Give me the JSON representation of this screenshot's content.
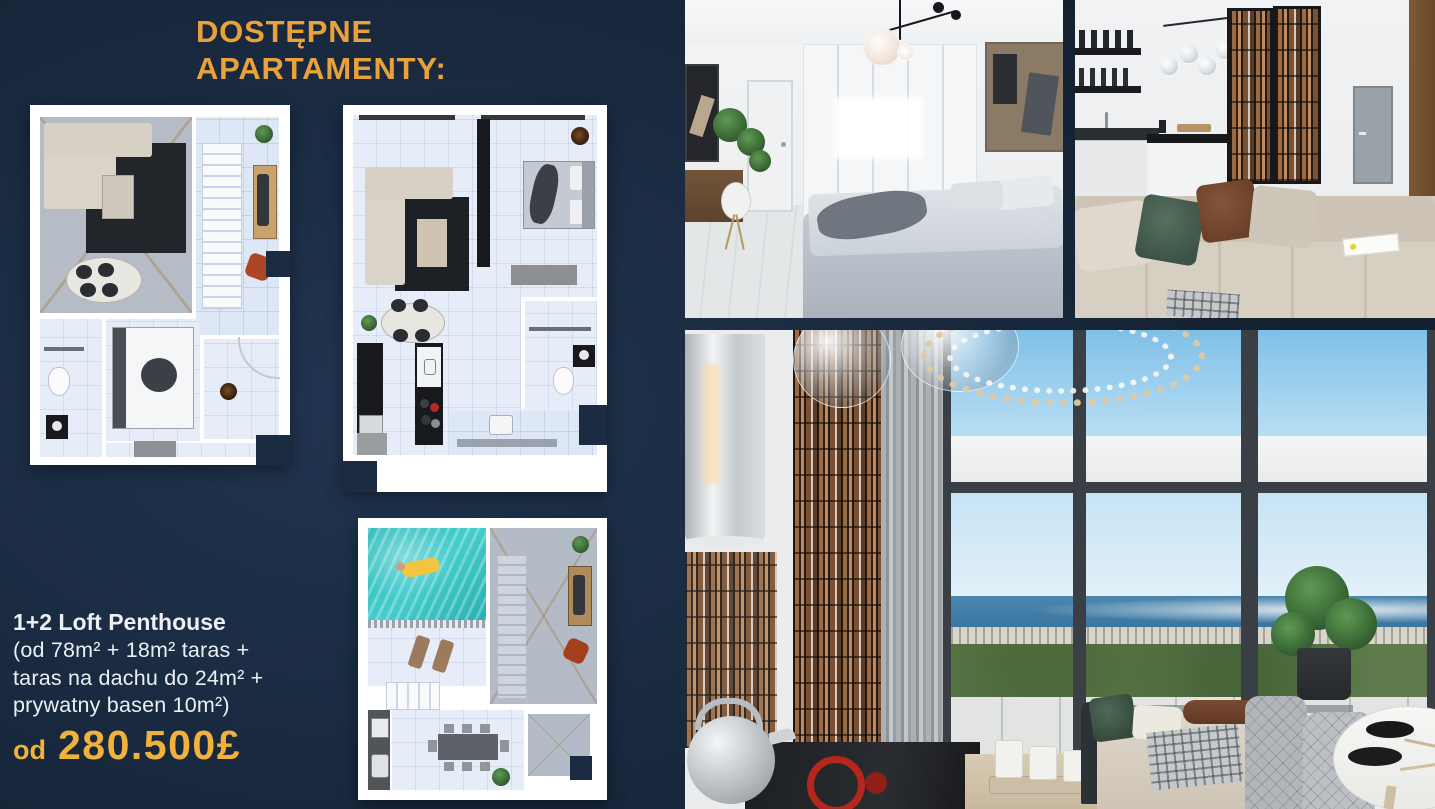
{
  "slide": {
    "title": {
      "line1": "DOSTĘPNE",
      "line2": "APARTAMENTY:"
    },
    "offer": {
      "name": "1+2 Loft Penthouse",
      "details": [
        "(od 78m² + 18m² taras +",
        "taras na dachu do 24m² +",
        "prywatny basen 10m²)"
      ],
      "price_prefix": "od",
      "price_value": "280.500£"
    },
    "colors": {
      "background_navy": "#1A2B42",
      "title_orange": "#E9A13C",
      "price_yellow": "#F1B23C",
      "text_white": "#ECEFF3"
    },
    "floorplans": [
      {
        "name": "apartment-main-level-floorplan"
      },
      {
        "name": "apartment-second-floorplan"
      },
      {
        "name": "roof-terrace-pool-floorplan"
      }
    ],
    "photos": [
      {
        "name": "bedroom-interior-render"
      },
      {
        "name": "kitchen-living-interior-render"
      },
      {
        "name": "loft-livingroom-seaview-render"
      }
    ]
  }
}
